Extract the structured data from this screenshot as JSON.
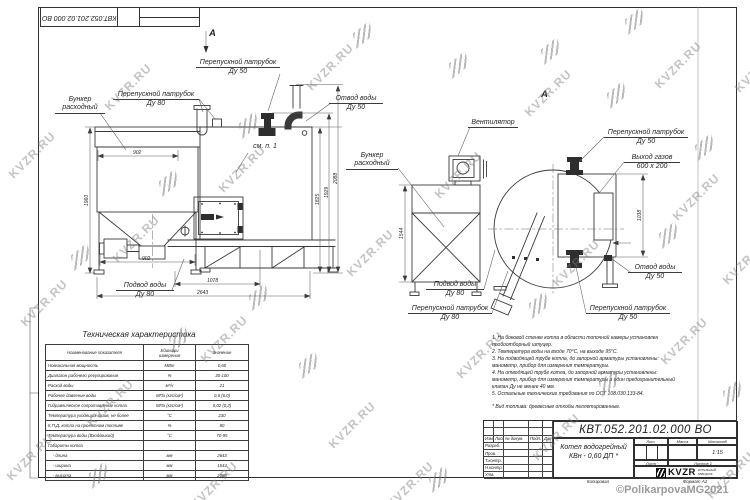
{
  "page": {
    "copyright": "©PolikarpovaMG2021",
    "kopiroval": "Копировал",
    "format": "Формат А2"
  },
  "watermark": {
    "text": "KVZR.RU"
  },
  "front_view": {
    "view_arrow": "А",
    "labels": {
      "bunker_l1": "Бункер",
      "bunker_l2": "расходный",
      "bypass80_l1": "Перепускной патрубок",
      "bypass80_l2": "Ду 80",
      "bypass50_l1": "Перепускной патрубок",
      "bypass50_l2": "Ду 50",
      "outlet_l1": "Отвод воды",
      "outlet_l2": "Ду 50",
      "see_item": "см. п. 1",
      "inlet_l1": "Подвод воды",
      "inlet_l2": "Ду 80"
    },
    "dims": {
      "bunker_width": "902",
      "legs_span": "902",
      "height_left": "1960",
      "base_length": "1078",
      "total_length": "2643",
      "h_body": "1825",
      "h_nozzle": "1929",
      "h_total": "2088"
    }
  },
  "side_view": {
    "view_label": "А",
    "labels": {
      "fan": "Вентилятор",
      "bunker_l1": "Бункер",
      "bunker_l2": "расходный",
      "bypass50_top_l1": "Перепускной патрубок",
      "bypass50_top_l2": "Ду 50",
      "gas_l1": "Выход газов",
      "gas_l2": "600 х 200",
      "outlet_l1": "Отвод воды",
      "outlet_l2": "Ду 50",
      "bypass50_bot_l1": "Перепускной патрубок",
      "bypass50_bot_l2": "Ду 50",
      "inlet_l1": "Подвод воды",
      "inlet_l2": "Ду 80",
      "bypass80_l1": "Перепускной патрубок",
      "bypass80_l2": "Ду 80"
    },
    "dims": {
      "width": "1544",
      "gas_duct_height": "1038"
    }
  },
  "spec_table": {
    "title": "Техническая характеристика",
    "col_name": "Наименование показателя",
    "col_units": "Единицы\nизмерения",
    "col_value": "Значение",
    "rows": [
      [
        "Номинальная мощность",
        "МВт",
        "0,60"
      ],
      [
        "Диапазон рабочего регулирования",
        "%",
        "30-100"
      ],
      [
        "Расход воды",
        "м³/ч",
        "21"
      ],
      [
        "Рабочее давление воды",
        "МПа (кгс/см²)",
        "0,6 (6,0)"
      ],
      [
        "Гидравлическое сопротивление котла",
        "МПа (кгс/см²)",
        "0,02 (0,2)"
      ],
      [
        "Температура уходящих газов, не более",
        "°С",
        "230"
      ],
      [
        "К.П.Д. котла на проектном топливе",
        "%",
        "80"
      ],
      [
        "Температура воды (Вход/выход)",
        "°С",
        "70-95"
      ],
      [
        "Габариты котла",
        "",
        ""
      ],
      [
        "    - длина",
        "мм",
        "2643"
      ],
      [
        "    - ширина",
        "мм",
        "1544"
      ],
      [
        "    - высота",
        "мм",
        "2088"
      ]
    ]
  },
  "notes": {
    "text": "1.  На боковой стенке котла в области топочной камеры установлен\nпробоотборный штуцер.\n2.  Температура воды на входе  70°С, на выходе  95°С.\n3.  На подводящей трубе котла, до запорной арматуры установлены:\nманометр, прибор для измерения температуры.\n4.  На отводящей трубе котла, до запорной арматуры установлены:\nманометр, прибор для измерения температуры и один предохранительный\nклапан Ду не менее 40 мм.\n5.  Остальные технические требования по ОСТ 108.030.133-84.",
    "fuel": "* Вид топлива:  древесные отходы пеллетированные."
  },
  "title_block": {
    "doc_number": "КВТ.052.201.02.000 ВО",
    "name_l1": "Котел водогрейный",
    "name_l2": "КВн - 0,60   ДП *",
    "lit_label": "Лит.",
    "mass_label": "Масса",
    "scale_label": "Масштаб",
    "scale_value": "1:15",
    "sheet_label": "Лист",
    "sheets_label": "Листов 1",
    "sig_headers": [
      "Изм.",
      "Лист",
      "№ докум.",
      "Подп.",
      "Дата"
    ],
    "sig_rows": [
      "Разраб.",
      "Пров.",
      "Т.контр.",
      "Н.контр.",
      "Утв."
    ],
    "logo_text": "KVZR",
    "logo_sub": "КОТЕЛЬНЫЙ\nЗАВОД РФ"
  }
}
